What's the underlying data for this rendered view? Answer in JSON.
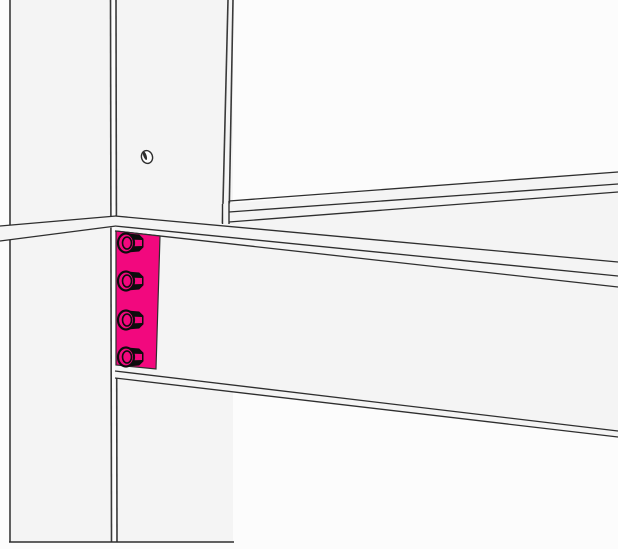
{
  "view": {
    "title": "steel-connection-3d-view",
    "width": 618,
    "height": 549,
    "background": "#fcfcfc"
  },
  "palette": {
    "face": "#f4f4f4",
    "edge": "#2e2e2e",
    "edge_heavy": "#3a3a3a",
    "selection_pink": "#F2087E",
    "bolt_dark": "#0d0d0d",
    "hole_fill": "#fdfdfd"
  },
  "model": {
    "selected_part": "end-plate",
    "bolt_count": 4,
    "bolt_hole_count": 1
  },
  "parts": [
    {
      "name": "column",
      "interactable": true,
      "shapes": [
        {
          "n": "column-left-flange-face",
          "t": "poly",
          "pts": [
            [
              10,
              0
            ],
            [
              111,
              0
            ],
            [
              111,
              542
            ],
            [
              10,
              542
            ]
          ],
          "fill": "face"
        },
        {
          "n": "column-web-face",
          "t": "poly",
          "pts": [
            [
              116,
              0
            ],
            [
              233,
              0
            ],
            [
              233,
              542
            ],
            [
              116,
              542
            ]
          ],
          "fill": "face"
        },
        {
          "n": "column-edge-left",
          "t": "line",
          "p1": [
            10,
            0
          ],
          "p2": [
            10,
            542
          ],
          "stroke": "edge_heavy",
          "w": 1.6
        },
        {
          "n": "column-edge-flange-inner",
          "t": "line",
          "p1": [
            110.5,
            0
          ],
          "p2": [
            111.5,
            542
          ],
          "stroke": "edge_heavy",
          "w": 1.6
        },
        {
          "n": "column-edge-web-near",
          "t": "line",
          "p1": [
            116,
            0
          ],
          "p2": [
            117,
            542
          ],
          "stroke": "edge_heavy",
          "w": 1.6
        },
        {
          "n": "column-edge-right-a",
          "t": "line",
          "p1": [
            228,
            0
          ],
          "p2": [
            222.5,
            223
          ],
          "stroke": "edge_heavy",
          "w": 1.6
        },
        {
          "n": "column-edge-right-b",
          "t": "line",
          "p1": [
            233,
            0
          ],
          "p2": [
            229,
            223
          ],
          "stroke": "edge_heavy",
          "w": 1.6
        },
        {
          "n": "column-bottom-cut-edge",
          "t": "line",
          "p1": [
            9,
            542
          ],
          "p2": [
            234,
            542
          ],
          "stroke": "edge",
          "w": 1.5
        },
        {
          "n": "bolt-hole",
          "t": "ellipse",
          "cx": 147,
          "cy": 157,
          "rx": 5.5,
          "ry": 6.5,
          "rot": -18,
          "fill": "hole_fill",
          "stroke": "edge",
          "w": 1.4
        },
        {
          "n": "bolt-hole-shading",
          "t": "ellipse",
          "cx": 144.9,
          "cy": 155.6,
          "rx": 1.6,
          "ry": 4.6,
          "rot": -20,
          "fill": "edge"
        }
      ]
    },
    {
      "name": "rear-beam",
      "interactable": true,
      "shapes": [
        {
          "n": "rear-beam-face",
          "t": "poly",
          "pts": [
            [
              222,
              204
            ],
            [
              618,
              171
            ],
            [
              618,
              263
            ],
            [
              222,
              228
            ]
          ],
          "fill": "face"
        },
        {
          "n": "rear-beam-flange-back-edge",
          "t": "line",
          "p1": [
            229,
            201
          ],
          "p2": [
            618,
            172
          ],
          "stroke": "edge",
          "w": 1.3
        },
        {
          "n": "rear-beam-flange-front-edge",
          "t": "line",
          "p1": [
            229,
            212
          ],
          "p2": [
            618,
            184
          ],
          "stroke": "edge",
          "w": 1.3
        },
        {
          "n": "rear-beam-flange-under-edge",
          "t": "line",
          "p1": [
            229,
            222
          ],
          "p2": [
            618,
            192
          ],
          "stroke": "edge",
          "w": 1.3
        },
        {
          "n": "rear-beam-end-edge-a",
          "t": "line",
          "p1": [
            222.5,
            204
          ],
          "p2": [
            222.5,
            224
          ],
          "stroke": "edge",
          "w": 1.4
        },
        {
          "n": "rear-beam-end-edge-b",
          "t": "line",
          "p1": [
            229,
            201
          ],
          "p2": [
            229,
            224
          ],
          "stroke": "edge",
          "w": 1.4
        }
      ]
    },
    {
      "name": "left-beam-segment",
      "interactable": true,
      "shapes": [
        {
          "n": "left-beam-flange-face",
          "t": "poly",
          "pts": [
            [
              0,
              226
            ],
            [
              116,
              216
            ],
            [
              116,
              227
            ],
            [
              0,
              241
            ]
          ],
          "fill": "face"
        },
        {
          "n": "left-beam-top-edge",
          "t": "line",
          "p1": [
            0,
            226
          ],
          "p2": [
            116,
            216
          ],
          "stroke": "edge",
          "w": 1.3
        },
        {
          "n": "left-beam-bottom-edge",
          "t": "line",
          "p1": [
            0,
            241
          ],
          "p2": [
            116,
            226
          ],
          "stroke": "edge",
          "w": 1.3
        }
      ]
    },
    {
      "name": "main-beam",
      "interactable": true,
      "shapes": [
        {
          "n": "main-beam-top-flange-top-face",
          "t": "poly",
          "pts": [
            [
              115,
              216
            ],
            [
              618,
              262
            ],
            [
              618,
              276
            ],
            [
              115,
              226
            ]
          ],
          "fill": "face"
        },
        {
          "n": "main-beam-top-flange-front-face",
          "t": "poly",
          "pts": [
            [
              115,
              226
            ],
            [
              618,
              276
            ],
            [
              618,
              287
            ],
            [
              115,
              231
            ]
          ],
          "fill": "face"
        },
        {
          "n": "main-beam-web-face",
          "t": "poly",
          "pts": [
            [
              115,
              231
            ],
            [
              618,
              287
            ],
            [
              618,
              431
            ],
            [
              115,
              371
            ]
          ],
          "fill": "face"
        },
        {
          "n": "main-beam-bottom-flange-front-face",
          "t": "poly",
          "pts": [
            [
              115,
              371
            ],
            [
              618,
              431
            ],
            [
              618,
              437
            ],
            [
              115,
              378
            ]
          ],
          "fill": "face"
        },
        {
          "n": "main-beam-top-back-edge",
          "t": "line",
          "p1": [
            115,
            216
          ],
          "p2": [
            618,
            262
          ],
          "stroke": "edge",
          "w": 1.3
        },
        {
          "n": "main-beam-top-front-edge",
          "t": "line",
          "p1": [
            115,
            226
          ],
          "p2": [
            618,
            276
          ],
          "stroke": "edge",
          "w": 1.3
        },
        {
          "n": "main-beam-top-flange-under-edge",
          "t": "line",
          "p1": [
            115,
            231
          ],
          "p2": [
            618,
            287
          ],
          "stroke": "edge",
          "w": 1.3
        },
        {
          "n": "main-beam-bottom-flange-top-edge",
          "t": "line",
          "p1": [
            115,
            371
          ],
          "p2": [
            618,
            431
          ],
          "stroke": "edge",
          "w": 1.3
        },
        {
          "n": "main-beam-bottom-flange-bottom-edge",
          "t": "line",
          "p1": [
            115,
            378
          ],
          "p2": [
            618,
            437
          ],
          "stroke": "edge",
          "w": 1.3
        }
      ]
    },
    {
      "name": "end-plate",
      "interactable": true,
      "shapes": [
        {
          "n": "end-plate-face-selected",
          "t": "poly",
          "pts": [
            [
              116,
              231
            ],
            [
              160,
              236
            ],
            [
              156,
              369
            ],
            [
              116,
              365
            ]
          ],
          "fill": "selection_pink",
          "stroke": "edge",
          "w": 1.2
        }
      ]
    },
    {
      "name": "bolt-1",
      "interactable": true,
      "shapes": [
        {
          "n": "bolt-head-silhouette",
          "t": "poly",
          "pts": [
            [
              127,
              234
            ],
            [
              139,
              235
            ],
            [
              143,
              239
            ],
            [
              143,
              247
            ],
            [
              139,
              251
            ],
            [
              127,
              252
            ]
          ],
          "fill": "bolt_dark",
          "stroke": "bolt_dark",
          "w": 1
        },
        {
          "n": "bolt-head-mid-facet",
          "t": "poly",
          "pts": [
            [
              128,
              239.5
            ],
            [
              142,
              240
            ],
            [
              142,
              246
            ],
            [
              128,
              246.5
            ]
          ],
          "fill": "selection_pink"
        },
        {
          "n": "bolt-washer",
          "t": "ellipse",
          "cx": 126,
          "cy": 243,
          "rx": 8,
          "ry": 9.5,
          "fill": "selection_pink",
          "stroke": "bolt_dark",
          "w": 2.2
        },
        {
          "n": "bolt-head-end-chamfer",
          "t": "ellipse",
          "cx": 127,
          "cy": 243,
          "rx": 4.5,
          "ry": 6,
          "fill": "none",
          "stroke": "bolt_dark",
          "w": 1.6
        }
      ]
    },
    {
      "name": "bolt-2",
      "interactable": true,
      "shapes": [
        {
          "n": "bolt-head-silhouette",
          "t": "poly",
          "pts": [
            [
              127,
              272
            ],
            [
              139,
              273
            ],
            [
              143,
              277
            ],
            [
              143,
              285
            ],
            [
              139,
              289
            ],
            [
              127,
              290
            ]
          ],
          "fill": "bolt_dark",
          "stroke": "bolt_dark",
          "w": 1
        },
        {
          "n": "bolt-head-mid-facet",
          "t": "poly",
          "pts": [
            [
              128,
              277.5
            ],
            [
              142,
              278
            ],
            [
              142,
              284
            ],
            [
              128,
              284.5
            ]
          ],
          "fill": "selection_pink"
        },
        {
          "n": "bolt-washer",
          "t": "ellipse",
          "cx": 126,
          "cy": 281,
          "rx": 8,
          "ry": 9.5,
          "fill": "selection_pink",
          "stroke": "bolt_dark",
          "w": 2.2
        },
        {
          "n": "bolt-head-end-chamfer",
          "t": "ellipse",
          "cx": 127,
          "cy": 281,
          "rx": 4.5,
          "ry": 6,
          "fill": "none",
          "stroke": "bolt_dark",
          "w": 1.6
        }
      ]
    },
    {
      "name": "bolt-3",
      "interactable": true,
      "shapes": [
        {
          "n": "bolt-head-silhouette",
          "t": "poly",
          "pts": [
            [
              127,
              311
            ],
            [
              139,
              312
            ],
            [
              143,
              316
            ],
            [
              143,
              324
            ],
            [
              139,
              328
            ],
            [
              127,
              329
            ]
          ],
          "fill": "bolt_dark",
          "stroke": "bolt_dark",
          "w": 1
        },
        {
          "n": "bolt-head-mid-facet",
          "t": "poly",
          "pts": [
            [
              128,
              316.5
            ],
            [
              142,
              317
            ],
            [
              142,
              323
            ],
            [
              128,
              323.5
            ]
          ],
          "fill": "selection_pink"
        },
        {
          "n": "bolt-washer",
          "t": "ellipse",
          "cx": 126,
          "cy": 320,
          "rx": 8,
          "ry": 9.5,
          "fill": "selection_pink",
          "stroke": "bolt_dark",
          "w": 2.2
        },
        {
          "n": "bolt-head-end-chamfer",
          "t": "ellipse",
          "cx": 127,
          "cy": 320,
          "rx": 4.5,
          "ry": 6,
          "fill": "none",
          "stroke": "bolt_dark",
          "w": 1.6
        }
      ]
    },
    {
      "name": "bolt-4",
      "interactable": true,
      "shapes": [
        {
          "n": "bolt-head-silhouette",
          "t": "poly",
          "pts": [
            [
              127,
              348
            ],
            [
              139,
              349
            ],
            [
              143,
              353
            ],
            [
              143,
              361
            ],
            [
              139,
              365
            ],
            [
              127,
              366
            ]
          ],
          "fill": "bolt_dark",
          "stroke": "bolt_dark",
          "w": 1
        },
        {
          "n": "bolt-head-mid-facet",
          "t": "poly",
          "pts": [
            [
              128,
              353.5
            ],
            [
              142,
              354
            ],
            [
              142,
              360
            ],
            [
              128,
              360.5
            ]
          ],
          "fill": "selection_pink"
        },
        {
          "n": "bolt-washer",
          "t": "ellipse",
          "cx": 126,
          "cy": 357,
          "rx": 8,
          "ry": 9.5,
          "fill": "selection_pink",
          "stroke": "bolt_dark",
          "w": 2.2
        },
        {
          "n": "bolt-head-end-chamfer",
          "t": "ellipse",
          "cx": 127,
          "cy": 357,
          "rx": 4.5,
          "ry": 6,
          "fill": "none",
          "stroke": "bolt_dark",
          "w": 1.6
        }
      ]
    }
  ]
}
